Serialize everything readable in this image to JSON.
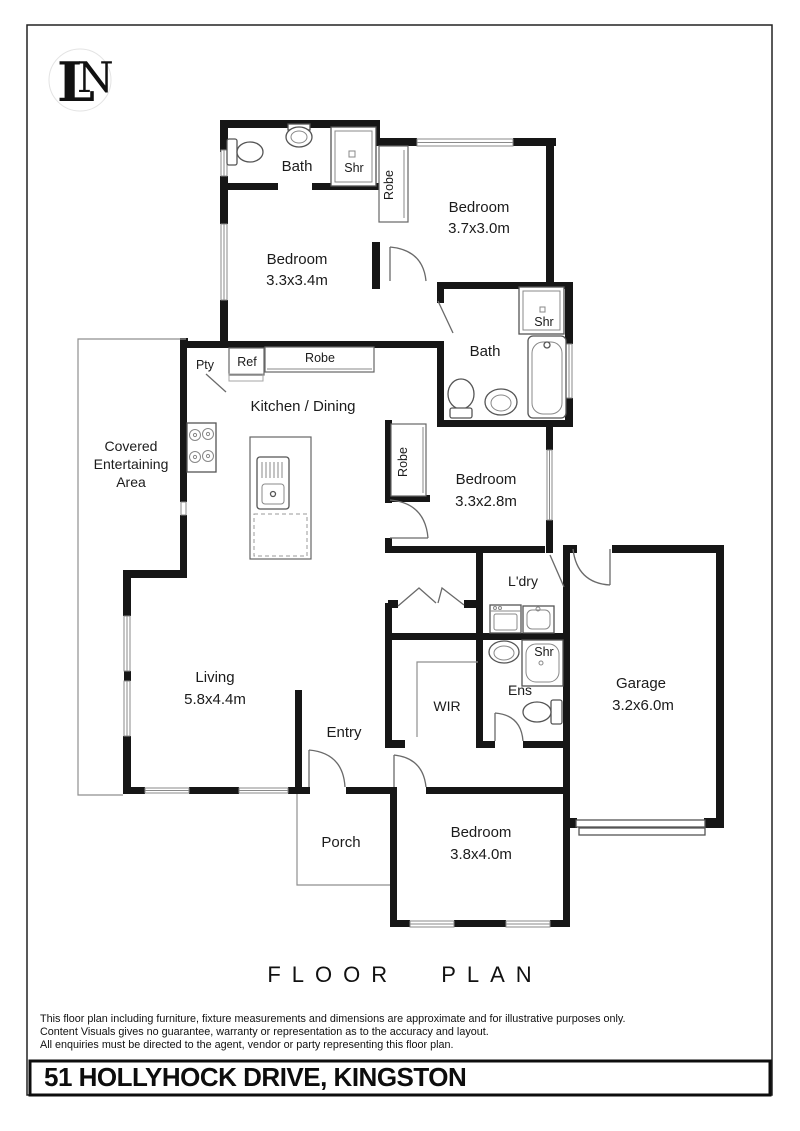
{
  "page": {
    "logo": {
      "letter_l": "L",
      "letter_n": "N"
    },
    "title": "FLOOR PLAN",
    "address": "51 HOLLYHOCK DRIVE, KINGSTON",
    "disclaimer_lines": [
      "This floor plan including furniture, fixture measurements and dimensions are approximate and for illustrative purposes only.",
      "Content Visuals gives no guarantee, warranty or representation as to the accuracy and layout.",
      "All enquiries must be directed to the agent, vendor or party representing this floor plan."
    ]
  },
  "rooms": {
    "bath_top": {
      "name": "Bath"
    },
    "shower_top": {
      "name": "Shr"
    },
    "robe_top": {
      "name": "Robe"
    },
    "bedroom_top_right": {
      "name": "Bedroom",
      "dims": "3.7x3.0m"
    },
    "bedroom_top_left": {
      "name": "Bedroom",
      "dims": "3.3x3.4m"
    },
    "pantry": {
      "name": "Pty"
    },
    "fridge": {
      "name": "Ref"
    },
    "robe_mid": {
      "name": "Robe"
    },
    "kitchen_dining": {
      "name": "Kitchen / Dining"
    },
    "bath_mid": {
      "name": "Bath"
    },
    "shower_mid": {
      "name": "Shr"
    },
    "robe_bed3": {
      "name": "Robe"
    },
    "bedroom_mid": {
      "name": "Bedroom",
      "dims": "3.3x2.8m"
    },
    "covered_area": {
      "line1": "Covered",
      "line2": "Entertaining",
      "line3": "Area"
    },
    "living": {
      "name": "Living",
      "dims": "5.8x4.4m"
    },
    "entry": {
      "name": "Entry"
    },
    "wir": {
      "name": "WIR"
    },
    "laundry": {
      "name": "L'dry"
    },
    "ensuite": {
      "name": "Ens"
    },
    "shower_ens": {
      "name": "Shr"
    },
    "garage": {
      "name": "Garage",
      "dims": "3.2x6.0m"
    },
    "bedroom_bottom": {
      "name": "Bedroom",
      "dims": "3.8x4.0m"
    },
    "porch": {
      "name": "Porch"
    }
  },
  "colors": {
    "wall": "#161616",
    "fixture": "#555555",
    "window": "#8a8a8a",
    "paper": "#ffffff"
  }
}
